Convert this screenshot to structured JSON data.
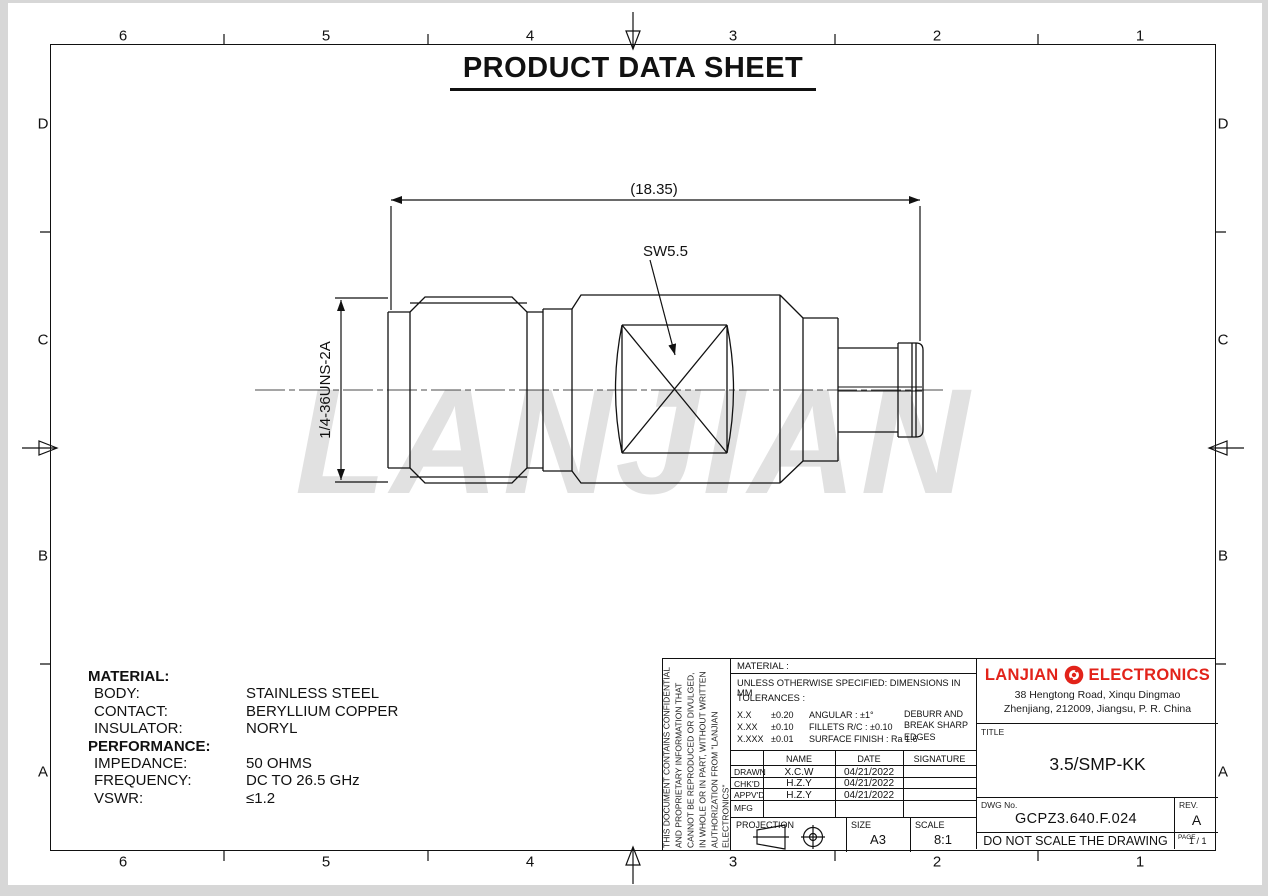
{
  "page": {
    "title": "PRODUCT DATA SHEET"
  },
  "watermark": "LANJIAN",
  "zones": {
    "top": [
      "6",
      "5",
      "4",
      "3",
      "2",
      "1"
    ],
    "bottom": [
      "6",
      "5",
      "4",
      "3",
      "2",
      "1"
    ],
    "left": [
      "D",
      "C",
      "B",
      "A"
    ],
    "right": [
      "D",
      "C",
      "B",
      "A"
    ]
  },
  "drawing": {
    "overall_length_dim": "(18.35)",
    "wrench_size_label": "SW5.5",
    "thread_label": "1/4-36UNS-2A"
  },
  "specs": {
    "material_heading": "MATERIAL:",
    "material_rows": [
      {
        "label": "BODY:",
        "value": "STAINLESS STEEL"
      },
      {
        "label": "CONTACT:",
        "value": "BERYLLIUM COPPER"
      },
      {
        "label": "INSULATOR:",
        "value": "NORYL"
      }
    ],
    "performance_heading": "PERFORMANCE:",
    "performance_rows": [
      {
        "label": "IMPEDANCE:",
        "value": "50 OHMS"
      },
      {
        "label": "FREQUENCY:",
        "value": "DC TO 26.5 GHz"
      },
      {
        "label": "VSWR:",
        "value": "≤1.2"
      }
    ]
  },
  "title_block": {
    "confidential": "THIS DOCUMENT CONTAINS CONFIDENTIAL AND PROPRIETARY INFORMATION THAT CANNOT BE REPRODUCED OR DIVULGED, IN WHOLE OR IN PART, WITHOUT WRITTEN AUTHORIZATION FROM \"LANJIAN ELECTRONICS\"",
    "material_label": "MATERIAL :",
    "spec_note": "UNLESS OTHERWISE SPECIFIED: DIMENSIONS IN MM",
    "tolerances_label": "TOLERANCES :",
    "tolerance_rows": [
      [
        "X.X",
        "±0.20",
        "ANGULAR : ±1°"
      ],
      [
        "X.XX",
        "±0.10",
        "FILLETS R/C : ±0.10"
      ],
      [
        "X.XXX",
        "±0.01",
        "SURFACE FINISH : Ra 1.6"
      ]
    ],
    "deburr_note": "DEBURR AND BREAK SHARP EDGES",
    "approval_headers": [
      "NAME",
      "DATE",
      "SIGNATURE"
    ],
    "approval_rows": [
      {
        "role": "DRAWN",
        "name": "X.C.W",
        "date": "04/21/2022",
        "signature": ""
      },
      {
        "role": "CHK'D",
        "name": "H.Z.Y",
        "date": "04/21/2022",
        "signature": ""
      },
      {
        "role": "APPV'D",
        "name": "H.Z.Y",
        "date": "04/21/2022",
        "signature": ""
      },
      {
        "role": "MFG",
        "name": "",
        "date": "",
        "signature": ""
      }
    ],
    "projection_label": "PROJECTION",
    "size_label": "SIZE",
    "size_value": "A3",
    "scale_label": "SCALE",
    "scale_value": "8:1",
    "company": {
      "name_left": "LANJIAN",
      "name_right": "ELECTRONICS",
      "address_line1": "38 Hengtong Road, Xinqu Dingmao",
      "address_line2": "Zhenjiang, 212009, Jiangsu, P. R. China",
      "brand_color": "#e2231a"
    },
    "title_label": "TITLE",
    "title_value": "3.5/SMP-KK",
    "dwg_label": "DWG No.",
    "dwg_value": "GCPZ3.640.F.024",
    "rev_label": "REV.",
    "rev_value": "A",
    "note": "DO NOT SCALE THE DRAWING",
    "page_label": "PAGE",
    "page_value": "1 / 1"
  }
}
